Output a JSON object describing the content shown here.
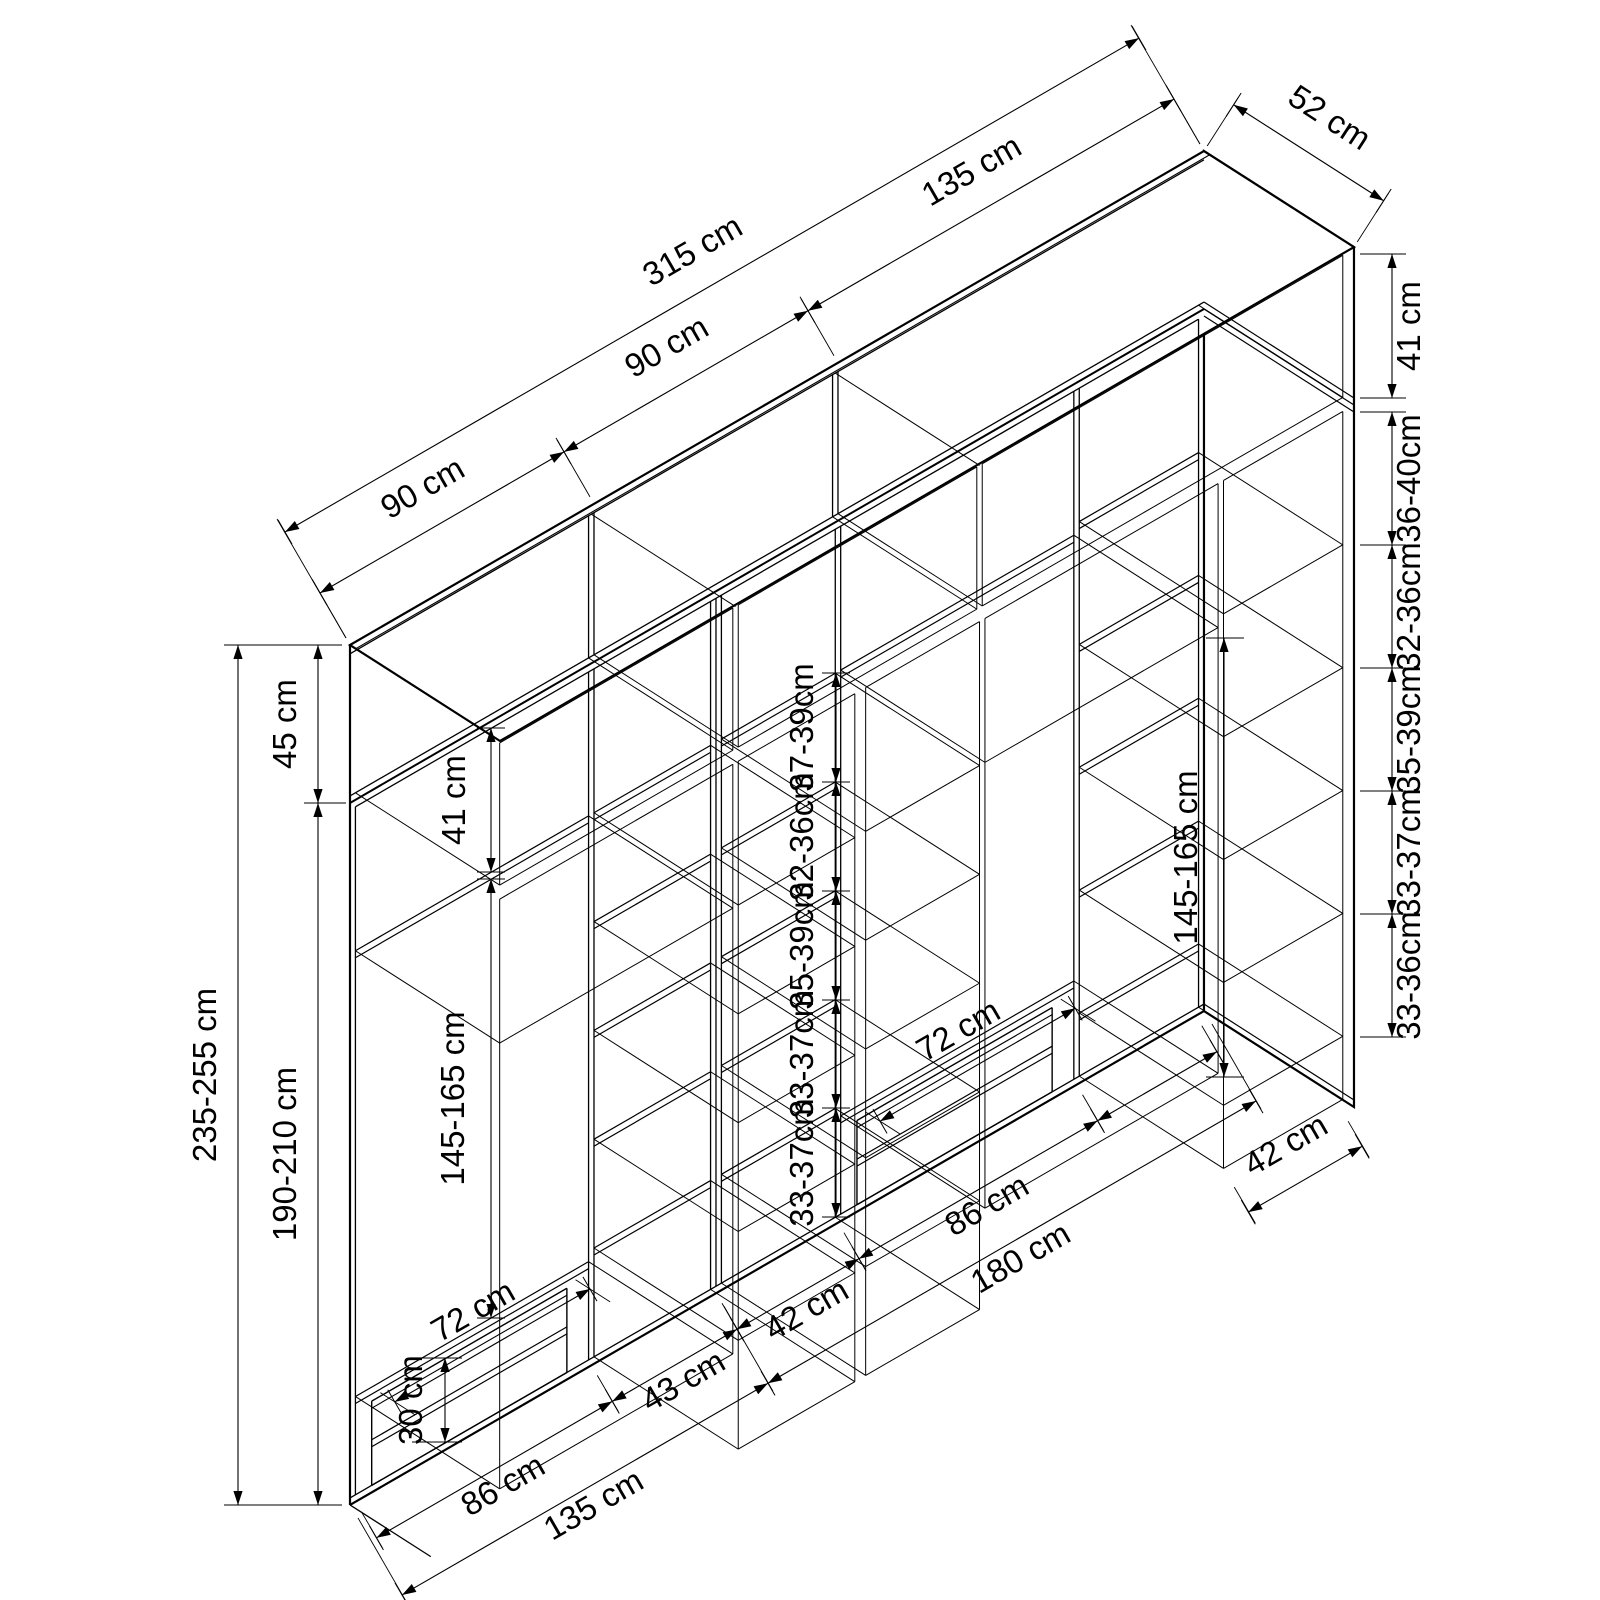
{
  "drawing": {
    "kind": "wardrobe-dimension-technical-diagram",
    "unit": "cm",
    "background_color": "#ffffff",
    "line_color": "#000000"
  },
  "dimensions": {
    "top": {
      "segments": [
        "90 cm",
        "90 cm",
        "135 cm"
      ],
      "total": "315 cm",
      "depth": "52 cm"
    },
    "left": {
      "total_height": "235-255 cm",
      "top_section": "45 cm",
      "lower_section": "190-210 cm"
    },
    "right": {
      "top_shelf_height": "41 cm",
      "shelf_gaps": [
        "36-40cm",
        "32-36cm",
        "35-39cm",
        "33-37cm",
        "33-36cm"
      ]
    },
    "middle": {
      "shelf_gaps": [
        "37-39cm",
        "32-36cm",
        "35-39cm",
        "33-37cm",
        "33-37cm"
      ]
    },
    "interior": {
      "upper_shelf_height": "41 cm",
      "hanging_left": "145-165 cm",
      "hanging_right": "145-165 cm",
      "drawer_stack_height": "30 cm",
      "drawer_width_left": "72 cm",
      "drawer_width_right": "72 cm"
    },
    "bottom": {
      "segments": [
        "86 cm",
        "43 cm",
        "42 cm",
        "86 cm"
      ],
      "right_column_width": "42 cm",
      "left_cabinet_width": "135 cm",
      "right_cabinet_width": "180 cm"
    }
  }
}
